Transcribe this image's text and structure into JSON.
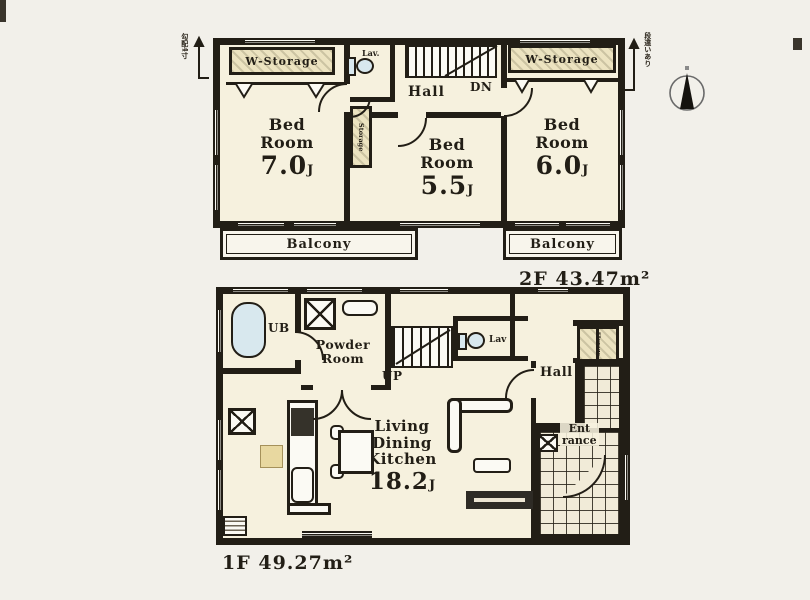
{
  "colors": {
    "background": "#f2f0ea",
    "ink": "#221e16",
    "room_fill": "#f6f1de",
    "storage_fill": "#ece3c0",
    "fixture_blue": "#d8e8ee",
    "tan": "#e8d8a0"
  },
  "compass": {
    "type": "north-arrow"
  },
  "roof_annotations": {
    "left": "勾配4寸",
    "right": "段違いあり"
  },
  "floor_2f": {
    "label": "2F",
    "area": "43.47m²",
    "walk_in_storage_left": "W-Storage",
    "walk_in_storage_right": "W-Storage",
    "lavatory": "Lav.",
    "hall": "Hall",
    "stairs_down": "DN",
    "storage": "Storage",
    "bedroom_left": {
      "name": "Bed\nRoom",
      "size": "7.0",
      "unit": "J"
    },
    "bedroom_center": {
      "name": "Bed\nRoom",
      "size": "5.5",
      "unit": "J"
    },
    "bedroom_right": {
      "name": "Bed\nRoom",
      "size": "6.0",
      "unit": "J"
    },
    "balcony_left": "Balcony",
    "balcony_right": "Balcony"
  },
  "floor_1f": {
    "label": "1F",
    "area": "49.27m²",
    "unit_bath": "UB",
    "powder_room": "Powder\nRoom",
    "stairs_up": "UP",
    "lavatory": "Lav",
    "hall": "Hall",
    "storage": "Storage",
    "entrance": "Ent\nrance",
    "ldk": {
      "name": "Living\nDining\nKitchen",
      "size": "18.2",
      "unit": "J"
    }
  }
}
